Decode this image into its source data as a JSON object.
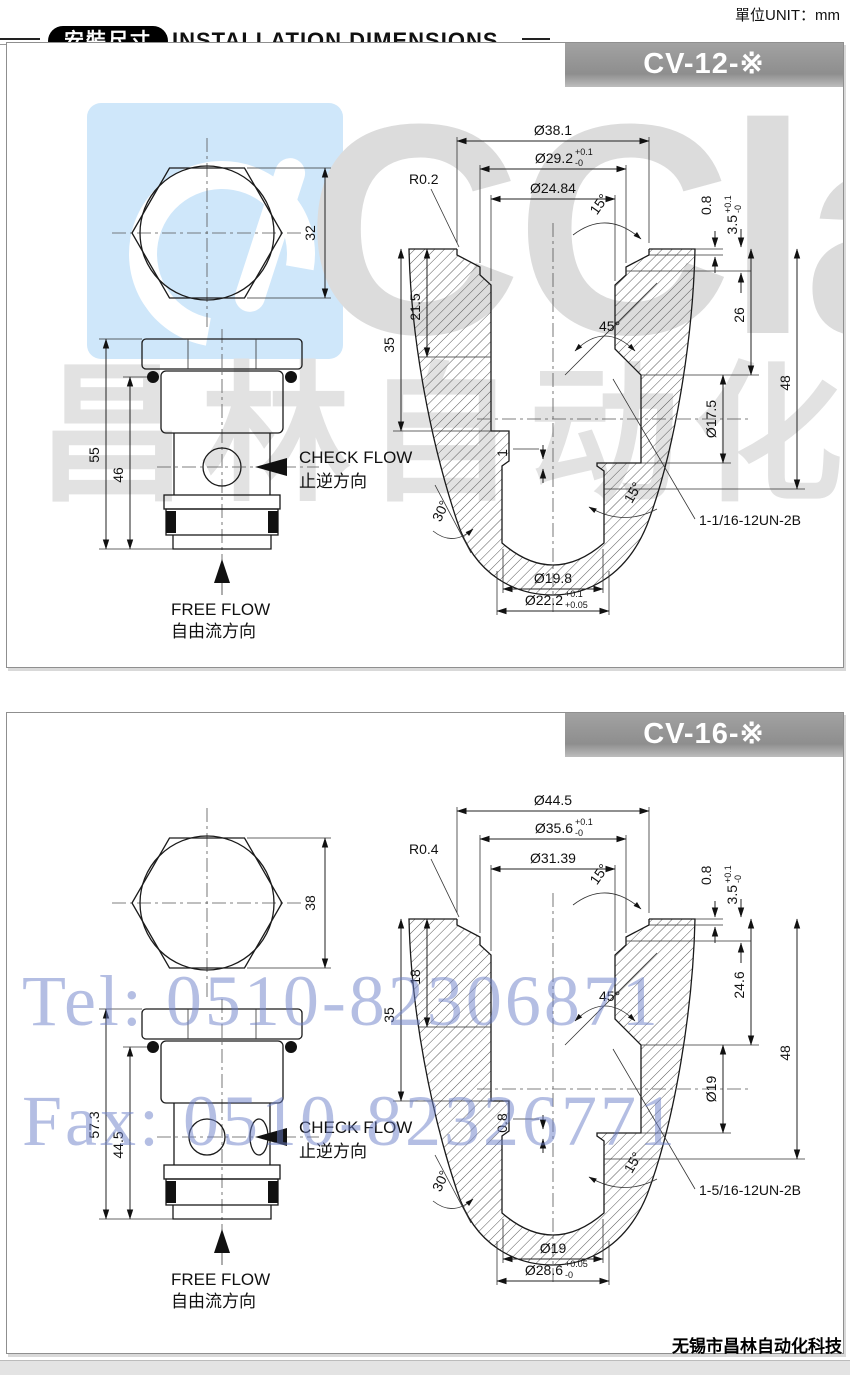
{
  "page": {
    "unit_label": "單位UNIT：mm",
    "badge": "安裝尺寸",
    "heading": "INSTALLATION DIMENSIONS",
    "footer": "无锡市昌林自动化科技"
  },
  "watermarks": {
    "logo_text": "CClair",
    "cn_text": "昌林自动化",
    "tel": "Tel: 0510-82306871",
    "fax": "Fax: 0510-82326771",
    "accent_blue": "#697dc8",
    "light_gray": "#dcdcdc",
    "logo_bg": "#cfe7fa"
  },
  "panels": [
    {
      "title": "CV-12-※",
      "flow": {
        "check_en": "CHECK FLOW",
        "check_cn": "止逆方向",
        "free_en": "FREE FLOW",
        "free_cn": "自由流方向"
      },
      "valve": {
        "hex_width": "32",
        "total_len": "55",
        "body_len": "46"
      },
      "cavity": {
        "dia_top": "Ø38.1",
        "dia_seat": "Ø29.2",
        "dia_seat_tu": "+0.1",
        "dia_seat_td": "-0",
        "dia_bore": "Ø24.84",
        "radius": "R0.2",
        "angle_top": "15°",
        "lip": "0.8",
        "cb_depth": "3.5",
        "cb_tu": "+0.1",
        "cb_td": "-0",
        "depth_seat": "21.5",
        "depth_main": "35",
        "angle_mid": "45°",
        "right_h1": "26",
        "right_h2": "48",
        "dia_mid": "Ø17.5",
        "undercut": "1",
        "angle_thread": "15°",
        "angle_bottom": "30°",
        "thread": "1-1/16-12UN-2B",
        "dia_b1": "Ø19.8",
        "dia_b2": "Ø22.2",
        "dia_b2_tu": "+0.1",
        "dia_b2_td": "+0.05"
      }
    },
    {
      "title": "CV-16-※",
      "flow": {
        "check_en": "CHECK FLOW",
        "check_cn": "止逆方向",
        "free_en": "FREE FLOW",
        "free_cn": "自由流方向"
      },
      "valve": {
        "hex_width": "38",
        "total_len": "57.3",
        "body_len": "44.5"
      },
      "cavity": {
        "dia_top": "Ø44.5",
        "dia_seat": "Ø35.6",
        "dia_seat_tu": "+0.1",
        "dia_seat_td": "-0",
        "dia_bore": "Ø31.39",
        "radius": "R0.4",
        "angle_top": "15°",
        "lip": "0.8",
        "cb_depth": "3.5",
        "cb_tu": "+0.1",
        "cb_td": "-0",
        "depth_seat": "18",
        "depth_main": "35",
        "angle_mid": "45°",
        "right_h1": "24.6",
        "right_h2": "48",
        "dia_mid": "Ø19",
        "undercut": "0.8",
        "angle_thread": "15°",
        "angle_bottom": "30°",
        "thread": "1-5/16-12UN-2B",
        "dia_b1": "Ø19",
        "dia_b2": "Ø28.6",
        "dia_b2_tu": "+0.05",
        "dia_b2_td": "-0"
      }
    }
  ]
}
